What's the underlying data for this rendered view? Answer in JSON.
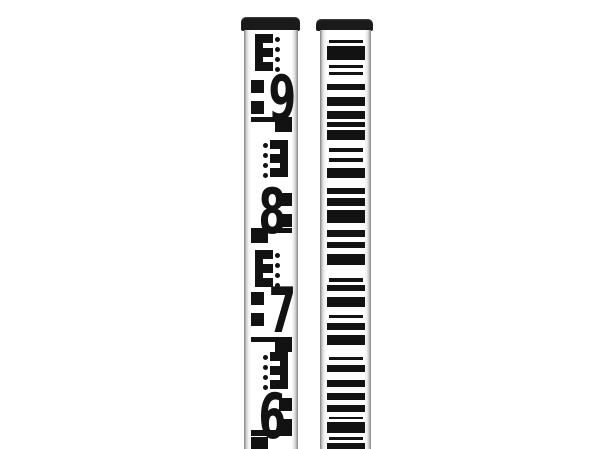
{
  "scene": {
    "description": "Two aluminum surveying leveling staffs standing vertically on a plain white background, cropped at the bottom edge",
    "background_color": "#ffffff",
    "mark_color": "#121212",
    "cap_color": "#1a1a1a"
  },
  "left_staff": {
    "kind": "E-pattern metric leveling staff",
    "digits_visible": [
      "9",
      "8",
      "7",
      "6"
    ],
    "cap": {
      "x": 241,
      "y": 17,
      "width": 59,
      "height": 14
    },
    "body": {
      "x": 244,
      "y": 30,
      "width": 54,
      "height": 419
    },
    "face": {
      "left_inset": 7,
      "width": 41
    },
    "geometry": {
      "e_spine_width": 8,
      "e_tooth_width": 10,
      "e_tooth_height": 9,
      "e_gap": 5,
      "dot_size": 5,
      "dot_spacing": 10,
      "digit_square": 13,
      "corner_bar_height": 5,
      "corner_square_width": 17,
      "corner_square_height": 15
    },
    "blocks": [
      {
        "digit": "9",
        "variant": "A",
        "corner_y": null,
        "e_y": 34,
        "digit_y": 72,
        "squares_y": [
          80,
          101
        ]
      },
      {
        "digit": "8",
        "variant": "B",
        "corner_y": 117,
        "e_y": 140,
        "digit_y": 185,
        "squares_y": [
          193,
          214
        ]
      },
      {
        "digit": "7",
        "variant": "A",
        "corner_y": 228,
        "e_y": 250,
        "digit_y": 284,
        "squares_y": [
          292,
          313
        ]
      },
      {
        "digit": "6",
        "variant": "B",
        "corner_y": 337,
        "e_y": 352,
        "digit_y": 390,
        "squares_y": [
          398,
          419
        ]
      }
    ],
    "bottom_mark": {
      "variant": "A",
      "bar_y": 430,
      "bar_height": 6,
      "square_y": 437,
      "square_height": 12
    }
  },
  "right_staff": {
    "kind": "barcode leveling staff (for digital levels)",
    "cap": {
      "x": 316,
      "y": 19,
      "width": 57,
      "height": 12
    },
    "body": {
      "x": 320,
      "y": 30,
      "width": 51,
      "height": 419
    },
    "face": {
      "left_inset": 7,
      "width": 38
    },
    "bars": [
      [
        40,
        3
      ],
      [
        46,
        14
      ],
      [
        65,
        3
      ],
      [
        72,
        3
      ],
      [
        84,
        6
      ],
      [
        97,
        9
      ],
      [
        111,
        8
      ],
      [
        122,
        5
      ],
      [
        130,
        10
      ],
      [
        148,
        4
      ],
      [
        158,
        4
      ],
      [
        168,
        10
      ],
      [
        188,
        6
      ],
      [
        198,
        8
      ],
      [
        210,
        13
      ],
      [
        230,
        7
      ],
      [
        242,
        6
      ],
      [
        254,
        11
      ],
      [
        278,
        4
      ],
      [
        285,
        6
      ],
      [
        297,
        10
      ],
      [
        315,
        3
      ],
      [
        323,
        7
      ],
      [
        335,
        10
      ],
      [
        357,
        3
      ],
      [
        365,
        7
      ],
      [
        380,
        7
      ],
      [
        393,
        7
      ],
      [
        405,
        7
      ],
      [
        417,
        2
      ],
      [
        422,
        11
      ],
      [
        437,
        3
      ],
      [
        443,
        6
      ]
    ]
  }
}
